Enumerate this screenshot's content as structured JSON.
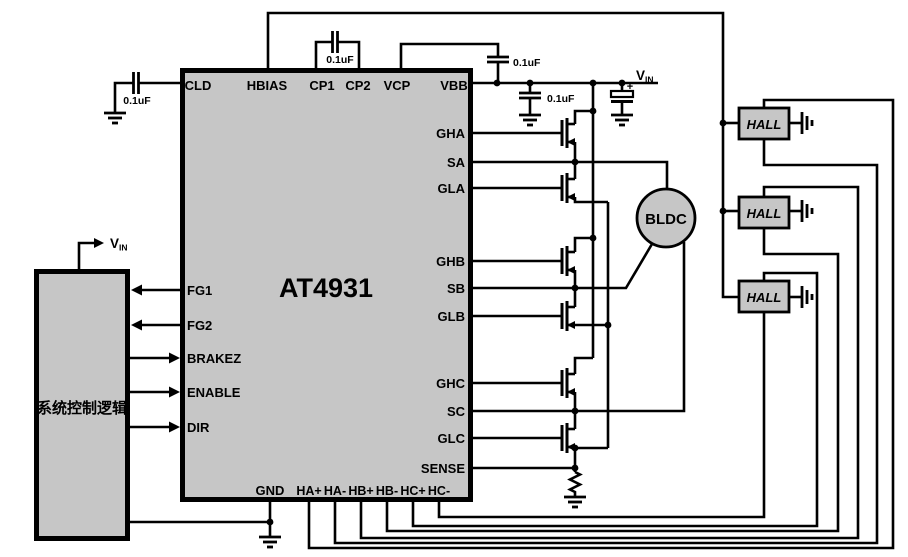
{
  "diagram": {
    "ic": {
      "title": "AT4931",
      "pins_top": [
        "CLD",
        "HBIAS",
        "CP1",
        "CP2",
        "VCP",
        "VBB"
      ],
      "pins_left": [
        "FG1",
        "FG2",
        "BRAKEZ",
        "ENABLE",
        "DIR"
      ],
      "pins_right": [
        "GHA",
        "SA",
        "GLA",
        "GHB",
        "SB",
        "GLB",
        "GHC",
        "SC",
        "GLC",
        "SENSE"
      ],
      "pins_bottom": [
        "GND",
        "HA+",
        "HA-",
        "HB+",
        "HB-",
        "HC+",
        "HC-"
      ]
    },
    "control_block": {
      "label": "系统控制逻辑"
    },
    "motor": {
      "label": "BLDC"
    },
    "hall_sensors": [
      "HALL",
      "HALL",
      "HALL"
    ],
    "capacitors": [
      "0.1uF",
      "0.1uF",
      "0.1uF",
      "0.1uF"
    ],
    "power": {
      "vin_base": "V",
      "vin_sub": "IN",
      "plus": "+"
    },
    "colors": {
      "block_fill": "#c6c6c6",
      "wire": "#000000",
      "background": "#ffffff"
    }
  }
}
